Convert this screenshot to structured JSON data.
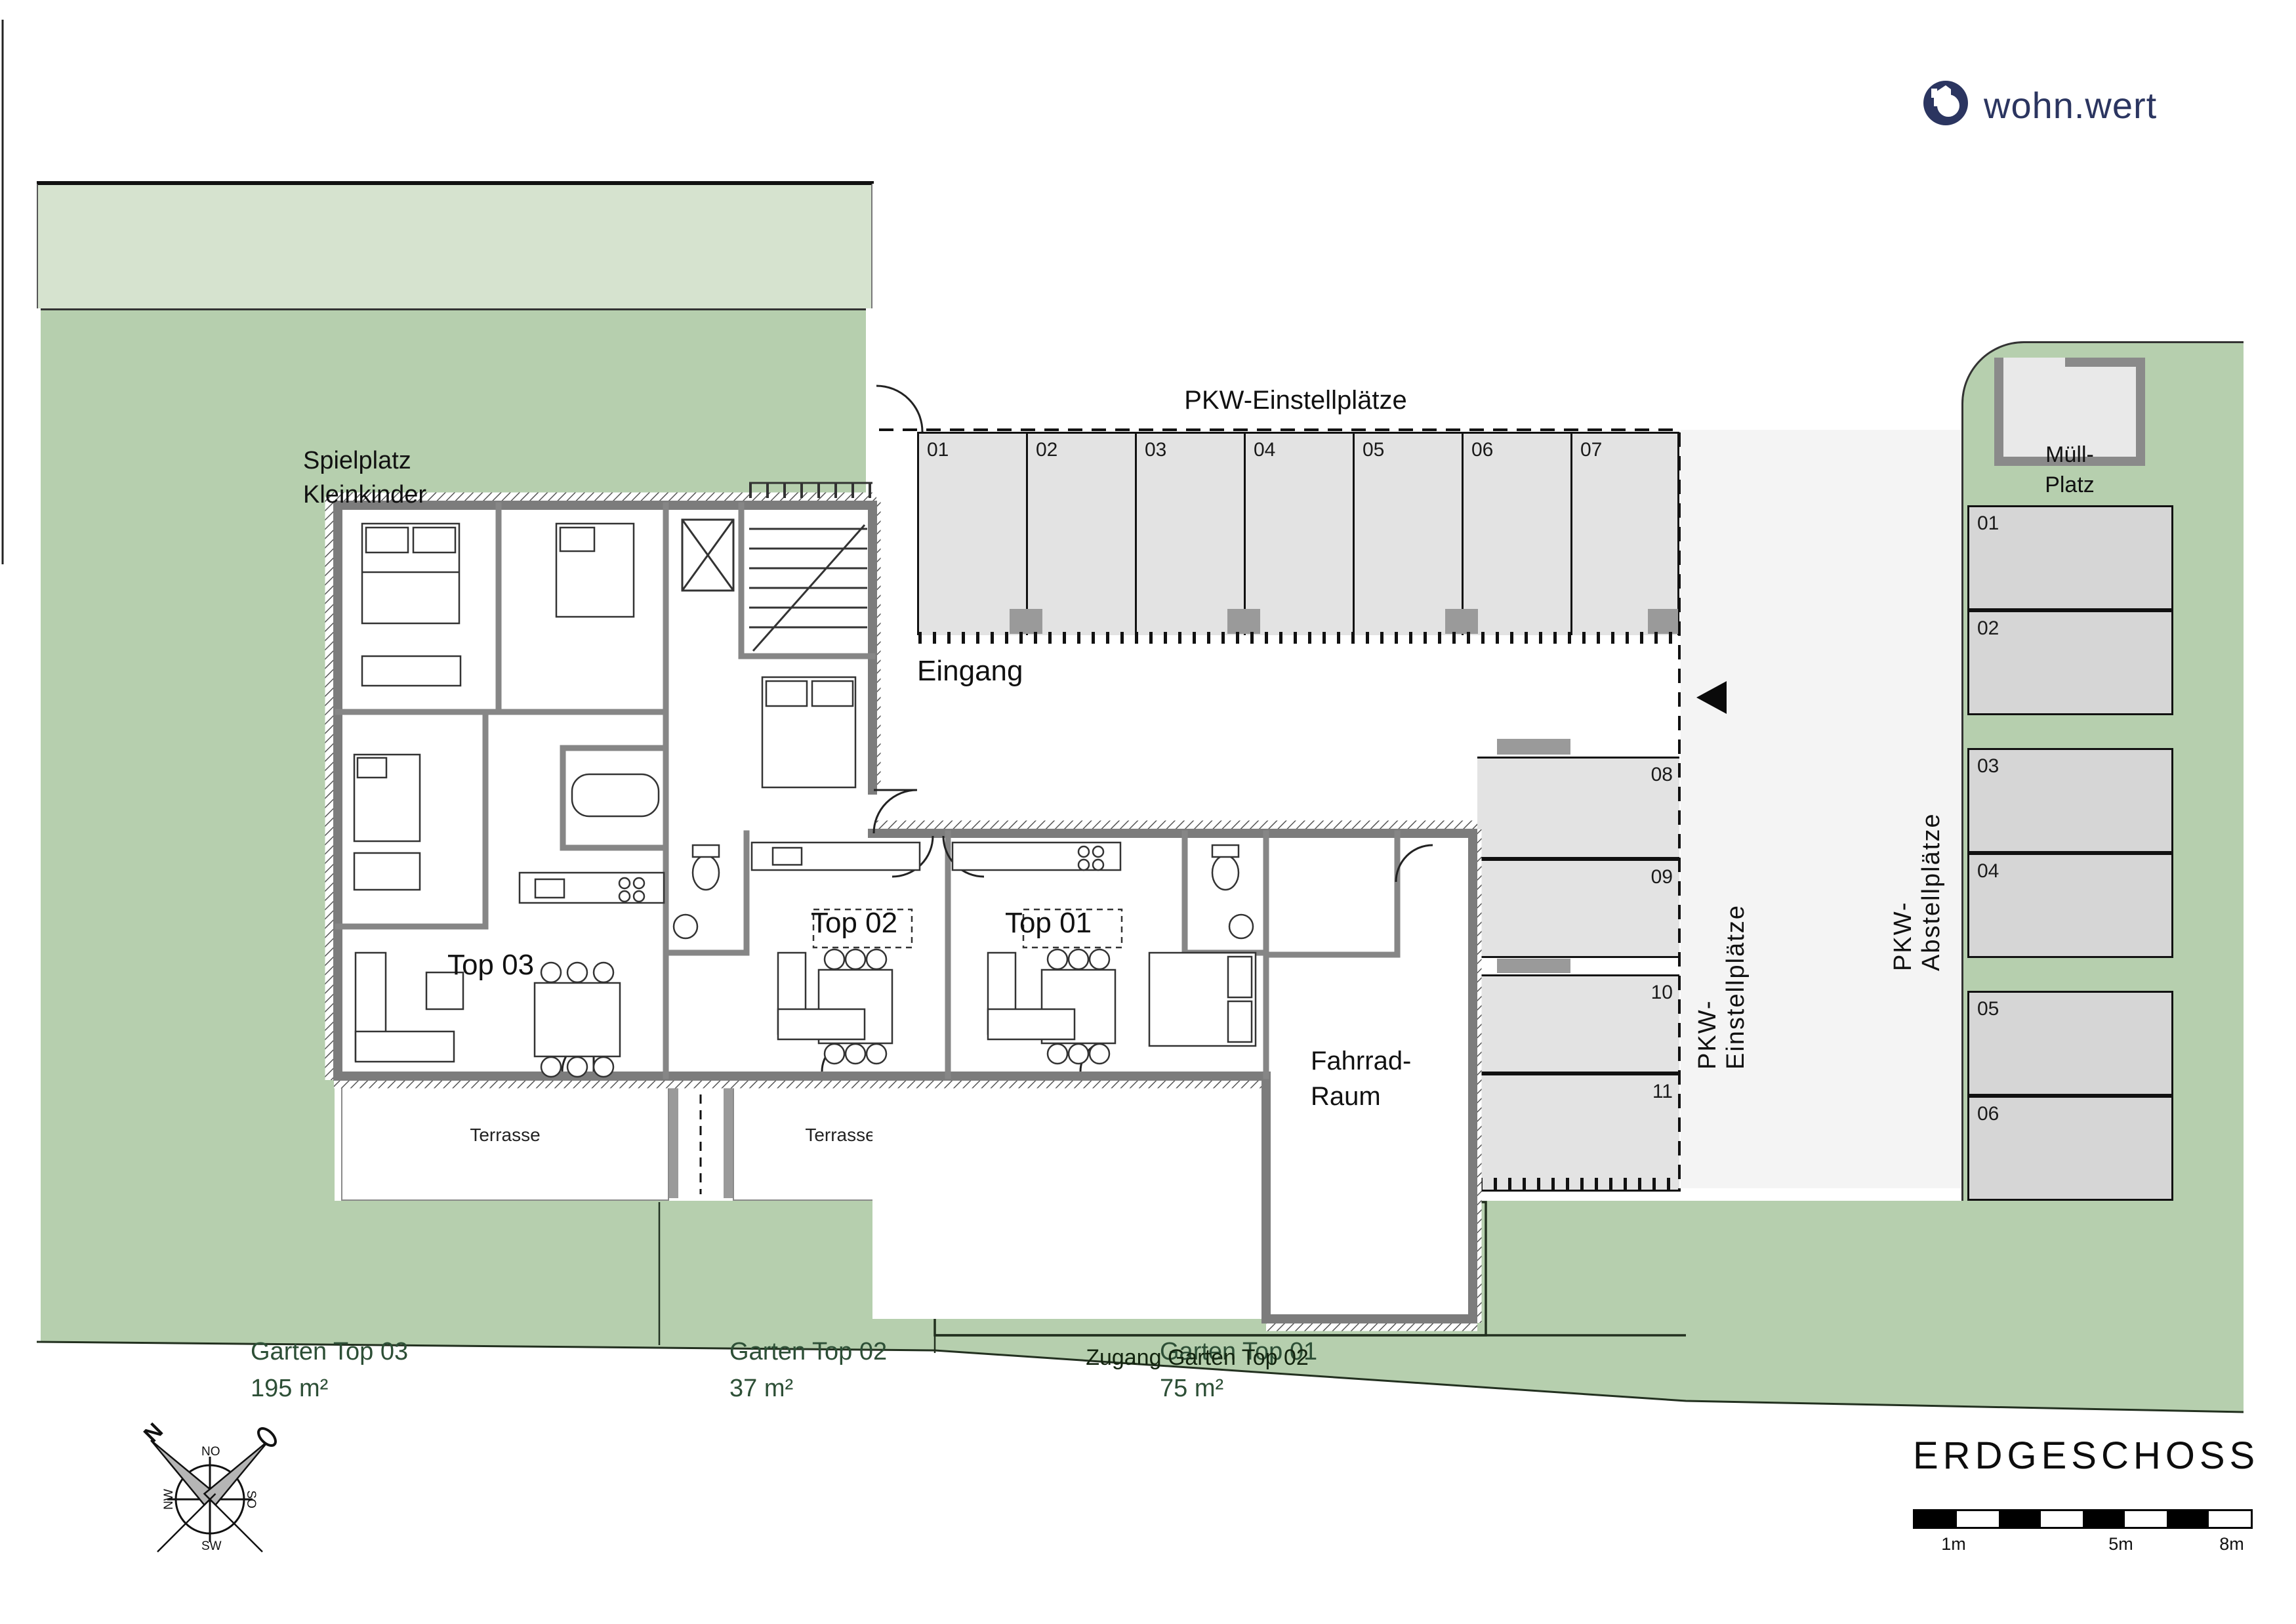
{
  "colors": {
    "site_green": "#b6cfae",
    "site_green_light": "#d6e3cf",
    "garden_text": "#2d4f36",
    "brand_navy": "#2b3560",
    "carport_fill": "#e3e3e3",
    "outdoor_parking_fill": "#d6d6d6",
    "wall_gray": "#7c7c7c"
  },
  "logo": {
    "name": "wohn.wert"
  },
  "site": {
    "playground": {
      "line1": "Spielplatz",
      "line2": "Kleinkinder"
    },
    "waste": {
      "line1": "Müll-",
      "line2": "Platz"
    },
    "gardens": [
      {
        "name": "Garten Top 03",
        "area": "195 m²"
      },
      {
        "name": "Garten Top 02",
        "area": "37 m²"
      },
      {
        "name": "Garten Top 01",
        "area": "75 m²"
      }
    ],
    "garden_access": "Zugang Garten Top 02"
  },
  "parking": {
    "carports_title": "PKW-Einstellplätze",
    "carport_spots": [
      "01",
      "02",
      "03",
      "04",
      "05",
      "06",
      "07"
    ],
    "lane_label": "PKW-Einstellplätze",
    "lane_spots": [
      "08",
      "09",
      "10",
      "11"
    ],
    "outdoor_label": "PKW-Abstellplätze",
    "outdoor_spots": [
      "01",
      "02",
      "03",
      "04",
      "05",
      "06"
    ]
  },
  "building": {
    "entrance": "Eingang",
    "apartments": [
      "Top 03",
      "Top 02",
      "Top 01"
    ],
    "bike_room": {
      "line1": "Fahrrad-",
      "line2": "Raum"
    },
    "terrace": "Terrasse"
  },
  "titleblock": {
    "floor_title": "ERDGESCHOSS",
    "scale_marks": [
      "1m",
      "5m",
      "8m"
    ]
  },
  "compass": {
    "north": "N",
    "ne": "NO",
    "nw": "NW",
    "se": "SO",
    "sw": "SW"
  }
}
